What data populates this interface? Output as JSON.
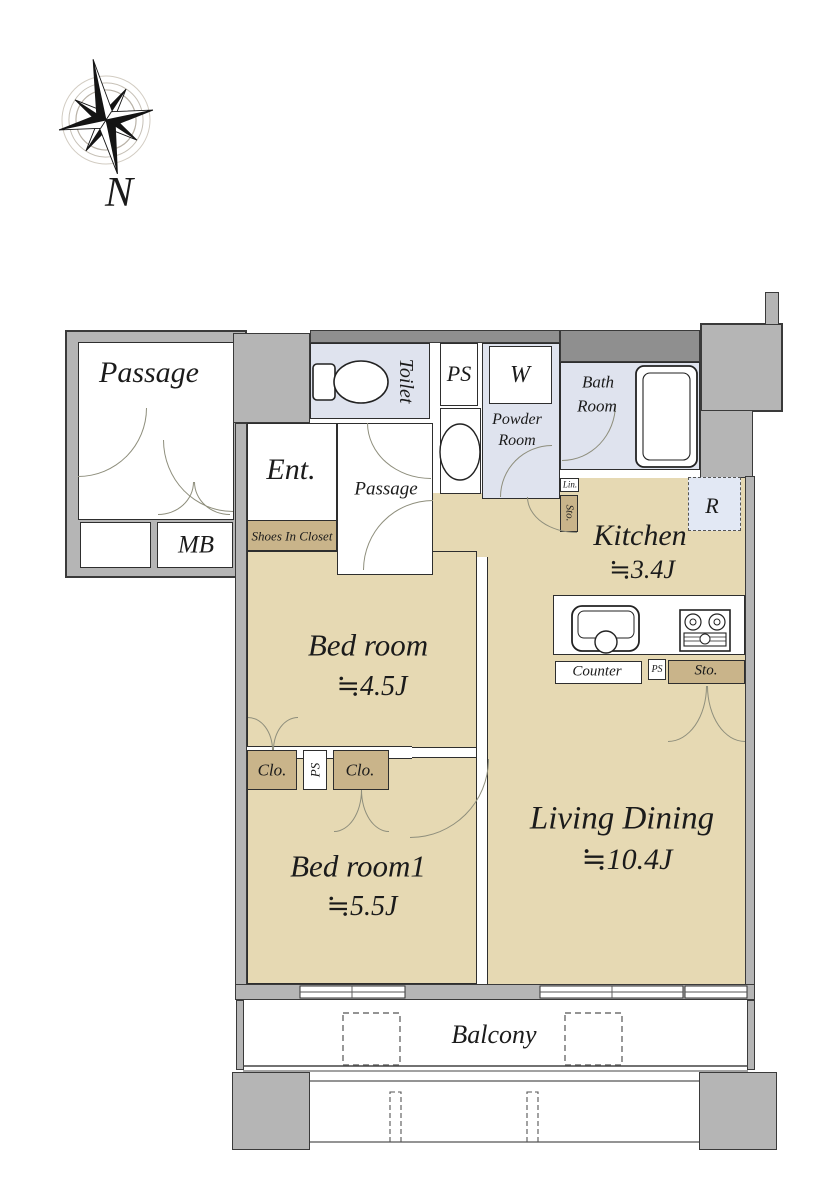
{
  "colors": {
    "wall": "#b5b5b5",
    "wall-dark": "#8f8f8f",
    "room-tan": "#e6d9b3",
    "closet-tan": "#c9b48a",
    "wet-blue": "#dfe3ee",
    "fridge-blue": "#e2e8f4"
  },
  "compass": {
    "north_label": "N"
  },
  "common": {
    "passage": "Passage",
    "mb": "MB"
  },
  "entrance": {
    "label": "Ent.",
    "shoes_closet": "Shoes In Closet",
    "inner_passage": "Passage"
  },
  "sanitary": {
    "toilet": "Toilet",
    "ps": "PS",
    "washer": "W",
    "powder_line1": "Powder",
    "powder_line2": "Room",
    "bath_line1": "Bath",
    "bath_line2": "Room",
    "linen": "Lin.",
    "storage": "Sto."
  },
  "kitchen": {
    "label": "Kitchen",
    "area": "≒3.4J",
    "fridge": "R",
    "counter": "Counter",
    "ps": "PS",
    "storage": "Sto."
  },
  "living": {
    "label": "Living Dining",
    "area": "≒10.4J"
  },
  "bedroom_a": {
    "label": "Bed room",
    "area": "≒4.5J"
  },
  "bedroom_b": {
    "label": "Bed room1",
    "area": "≒5.5J"
  },
  "closet_row": {
    "closet_left": "Clo.",
    "ps": "PS",
    "closet_right": "Clo."
  },
  "balcony": {
    "label": "Balcony"
  }
}
